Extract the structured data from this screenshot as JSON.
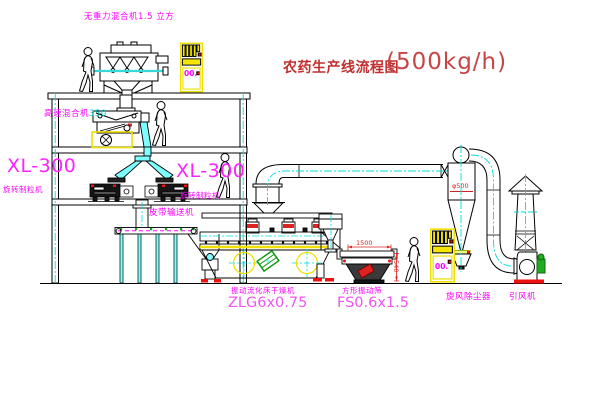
{
  "title": {
    "name": "农药生产线流程图",
    "capacity": "(500kg/h)"
  },
  "labels": {
    "top_mixer": "无重力混合机1.5 立方",
    "high_speed_mixer": {
      "name": "高速混合机",
      "value": "350"
    },
    "granulator_left": {
      "model": "XL-300",
      "name": "旋转制粒机"
    },
    "granulator_right": {
      "model": "XL-300",
      "name": "旋转制粒机"
    },
    "belt_conveyor": "皮带输送机",
    "fluid_bed_dryer": {
      "name": "振动流化床干燥机",
      "model": "ZLG6x0.75"
    },
    "vibrating_screen": {
      "name": "方形振动筛",
      "model": "FS0.6x1.5"
    },
    "cyclone": {
      "name": "旋风除尘器",
      "diameter": "φ500"
    },
    "fan": {
      "name": "引风机"
    },
    "dimensions": {
      "screen_length": "1500",
      "screen_height": "540"
    },
    "cabinet_top": {
      "display": "00."
    },
    "cabinet_right": {
      "display": "00."
    }
  },
  "colors": {
    "label_magenta": "#ff00ff",
    "title_red": "#c03030",
    "dimension_red": "#dd2222",
    "centerline_cyan": "#00dddd",
    "chute_cyan": "#7dffff",
    "cabinet_yellow": "#f0e000",
    "valve_green": "#119911",
    "background": "#ffffff"
  }
}
